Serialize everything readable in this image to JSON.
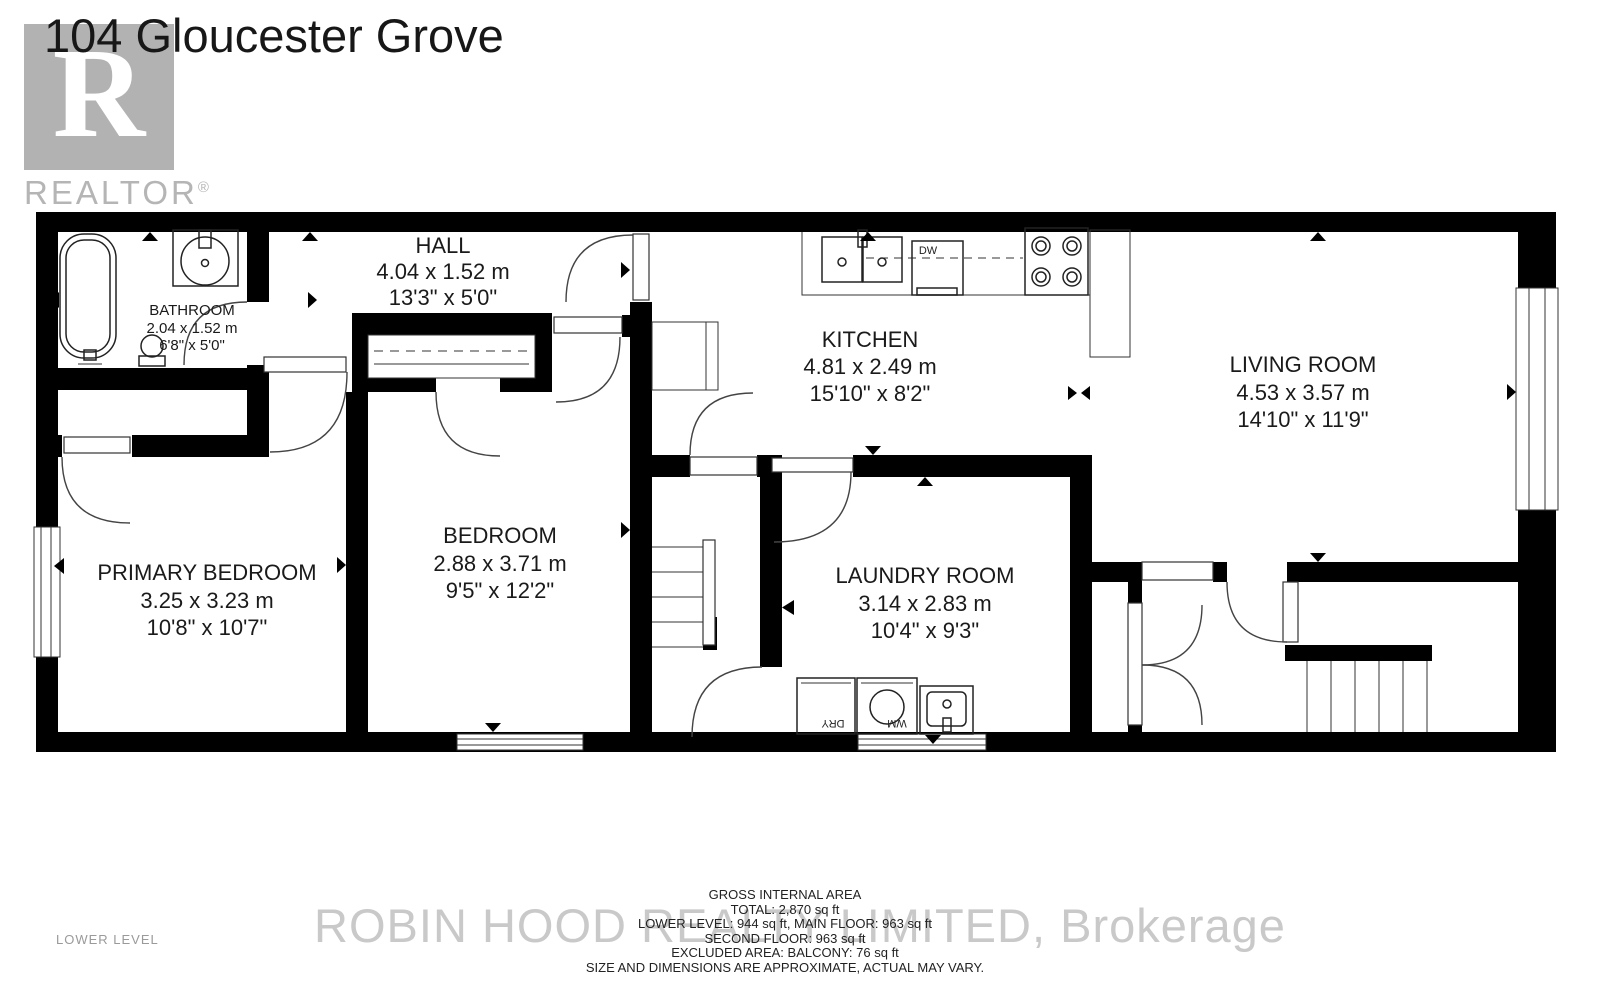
{
  "title": "104 Gloucester Grove",
  "level_label": "LOWER LEVEL",
  "watermark": {
    "brokerage": "ROBIN HOOD REALTY LIMITED, Brokerage",
    "logo_letter": "R",
    "logo_text": "REALTOR",
    "logo_reg": "®"
  },
  "footer": {
    "lines": [
      "GROSS INTERNAL AREA",
      "TOTAL: 2,870 sq ft",
      "LOWER LEVEL: 944 sq ft, MAIN FLOOR: 963 sq ft",
      "SECOND FLOOR: 963 sq ft",
      "EXCLUDED AREA: BALCONY: 76 sq ft",
      "SIZE AND DIMENSIONS ARE APPROXIMATE, ACTUAL MAY VARY."
    ]
  },
  "rooms": {
    "bathroom": {
      "name": "BATHROOM",
      "metric": "2.04 x 1.52 m",
      "imperial": "6'8\" x 5'0\""
    },
    "hall": {
      "name": "HALL",
      "metric": "4.04 x 1.52 m",
      "imperial": "13'3\" x 5'0\""
    },
    "kitchen": {
      "name": "KITCHEN",
      "metric": "4.81 x 2.49 m",
      "imperial": "15'10\" x 8'2\""
    },
    "living": {
      "name": "LIVING ROOM",
      "metric": "4.53 x 3.57 m",
      "imperial": "14'10\" x 11'9\""
    },
    "primary": {
      "name": "PRIMARY BEDROOM",
      "metric": "3.25 x 3.23 m",
      "imperial": "10'8\" x 10'7\""
    },
    "bedroom": {
      "name": "BEDROOM",
      "metric": "2.88 x 3.71 m",
      "imperial": "9'5\" x 12'2\""
    },
    "laundry": {
      "name": "LAUNDRY ROOM",
      "metric": "3.14 x 2.83 m",
      "imperial": "10'4\" x 9'3\""
    }
  },
  "appliances": {
    "dishwasher": "DW",
    "washer": "WM",
    "dryer": "DRY"
  },
  "colors": {
    "wall": "#000000",
    "watermark_gray": "#c9c9c9",
    "logo_gray": "#b5b5b5",
    "text": "#1a1a1a"
  }
}
